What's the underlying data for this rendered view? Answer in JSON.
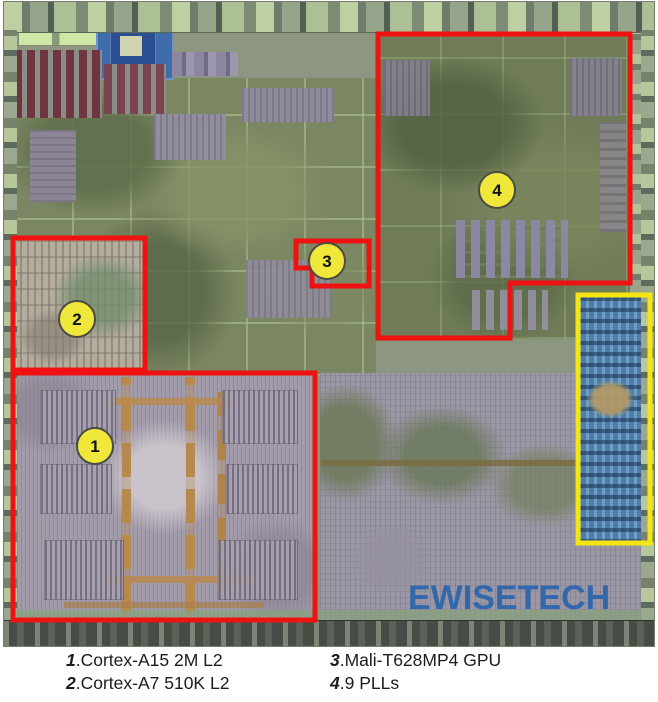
{
  "figure": {
    "watermark": {
      "text": "EWISETECH",
      "color": "#2160ae"
    },
    "outline_color": "#ee1212",
    "highlight_color": "#f4e612",
    "marker_style": {
      "r": 18,
      "fill": "#efe73a",
      "border": "#4b4b43"
    },
    "regions": [
      {
        "id": "1",
        "shape": "rect",
        "x": 9,
        "y": 371,
        "w": 302,
        "h": 247,
        "color": "#ee1212",
        "stroke": 5
      },
      {
        "id": "2",
        "shape": "rect",
        "x": 9,
        "y": 236,
        "w": 132,
        "h": 132,
        "color": "#ee1212",
        "stroke": 5
      },
      {
        "id": "3",
        "shape": "polygon",
        "points": "292,239 365,239 365,284 308,284 308,266 292,266",
        "color": "#ee1212",
        "stroke": 5
      },
      {
        "id": "4",
        "shape": "polygon",
        "points": "374,32 626,32 626,281 506,281 506,336 374,336",
        "color": "#ee1212",
        "stroke": 5
      },
      {
        "id": "analog-highlight",
        "shape": "rect",
        "x": 574,
        "y": 293,
        "w": 72,
        "h": 248,
        "color": "#f4e612",
        "stroke": 5
      }
    ],
    "markers": [
      {
        "label": "1",
        "cx": 91,
        "cy": 444
      },
      {
        "label": "2",
        "cx": 73,
        "cy": 317
      },
      {
        "label": "3",
        "cx": 323,
        "cy": 259
      },
      {
        "label": "4",
        "cx": 493,
        "cy": 188
      }
    ]
  },
  "legend": {
    "items": [
      {
        "num": "1",
        "label": ".Cortex-A15 2M L2"
      },
      {
        "num": "2",
        "label": ".Cortex-A7 510K L2"
      },
      {
        "num": "3",
        "label": ".Mali-T628MP4 GPU"
      },
      {
        "num": "4",
        "label": ".9 PLLs"
      }
    ]
  }
}
